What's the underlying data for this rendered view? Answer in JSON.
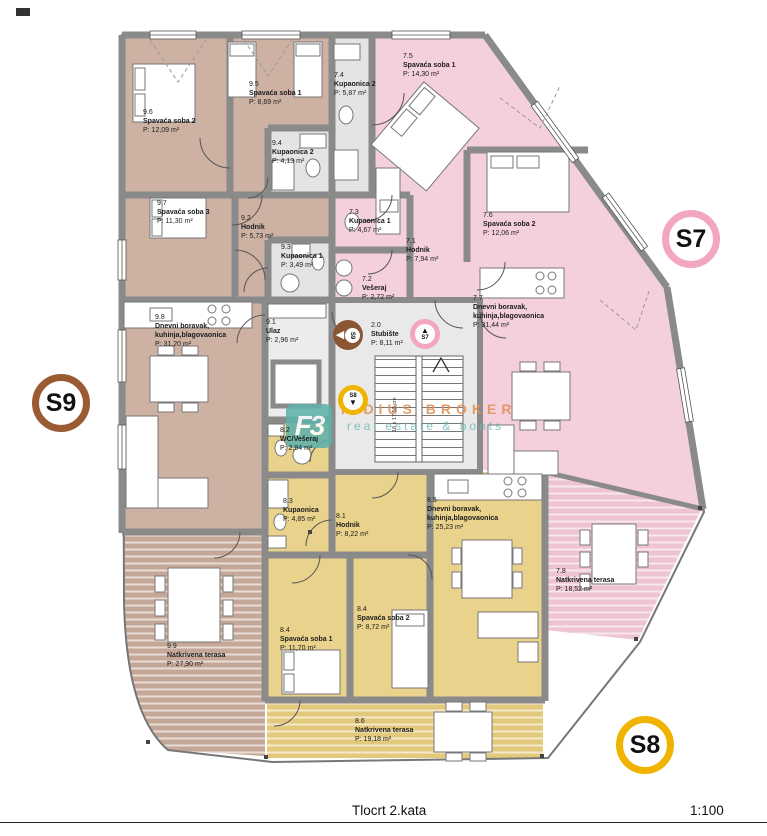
{
  "title_block": {
    "drawing_title": "Tlocrt 2.kata",
    "scale": "1:100"
  },
  "units": {
    "s7": {
      "label": "S7",
      "ring_color": "#f2a6c2",
      "fill_color": "#f4d0dc"
    },
    "s8": {
      "label": "S8",
      "ring_color": "#f0b400",
      "fill_color": "#e9d28b"
    },
    "s9": {
      "label": "S9",
      "ring_color": "#9a5b33",
      "fill_color": "#cdb2a3"
    }
  },
  "common": {
    "num": "2.0",
    "name": "Stubište",
    "area": "P: 8,11 m²",
    "stair_note": "16 x 17,50 cm"
  },
  "watermark": {
    "logo": "F3",
    "line1": "FIDIUS BROKER",
    "line2": "real estate & boats"
  },
  "rooms": [
    {
      "num": "9.6",
      "name": "Spavaća soba 2",
      "area": "P: 12,09 m²"
    },
    {
      "num": "9.5",
      "name": "Spavaća soba 1",
      "area": "P: 8,69 m²"
    },
    {
      "num": "9.4",
      "name": "Kupaonica 2",
      "area": "P: 4,13 m²"
    },
    {
      "num": "9.7",
      "name": "Spavaća soba 3",
      "area": "P: 11,30 m²"
    },
    {
      "num": "9.2",
      "name": "Hodnik",
      "area": "P: 5,73 m²"
    },
    {
      "num": "9.3",
      "name": "Kupaonica 1",
      "area": "P: 3,49 m²"
    },
    {
      "num": "9.8",
      "name": "Dnevni boravak,\nkuhinja,blagovaonica",
      "area": "P: 31,20 m²"
    },
    {
      "num": "9.1",
      "name": "Ulaz",
      "area": "P: 2,96 m²"
    },
    {
      "num": "9.9",
      "name": "Natkrivena terasa",
      "area": "P: 27,90 m²"
    },
    {
      "num": "7.5",
      "name": "Spavaća soba 1",
      "area": "P: 14,30 m²"
    },
    {
      "num": "7.4",
      "name": "Kupaonica 2",
      "area": "P: 5,87 m²"
    },
    {
      "num": "7.3",
      "name": "Kupaonica 1",
      "area": "P: 4,67 m²"
    },
    {
      "num": "7.1",
      "name": "Hodnik",
      "area": "P: 7,94 m²"
    },
    {
      "num": "7.6",
      "name": "Spavaća soba 2",
      "area": "P: 12,06 m²"
    },
    {
      "num": "7.2",
      "name": "Vešeraj",
      "area": "P: 2,72 m²"
    },
    {
      "num": "7.7",
      "name": "Dnevni boravak,\nkuhinja,blagovaonica",
      "area": "P: 31,44 m²"
    },
    {
      "num": "7.8",
      "name": "Natkrivena terasa",
      "area": "P: 18,52 m²"
    },
    {
      "num": "8.2",
      "name": "WC/Vešeraj",
      "area": "P: 2,94 m²"
    },
    {
      "num": "8.3",
      "name": "Kupaonica",
      "area": "P: 4,85 m²"
    },
    {
      "num": "8.1",
      "name": "Hodnik",
      "area": "P: 8,22 m²"
    },
    {
      "num": "8.5",
      "name": "Dnevni boravak,\nkuhinja,blagovaonica",
      "area": "P: 25,23 m²"
    },
    {
      "num": "8.4",
      "name": "Spavaća soba 1",
      "area": "P: 11,70 m²"
    },
    {
      "num": "8.4",
      "name": "Spavaća soba 2",
      "area": "P: 8,72 m²"
    },
    {
      "num": "8.6",
      "name": "Natkrivena terasa",
      "area": "P: 19,18 m²"
    }
  ]
}
